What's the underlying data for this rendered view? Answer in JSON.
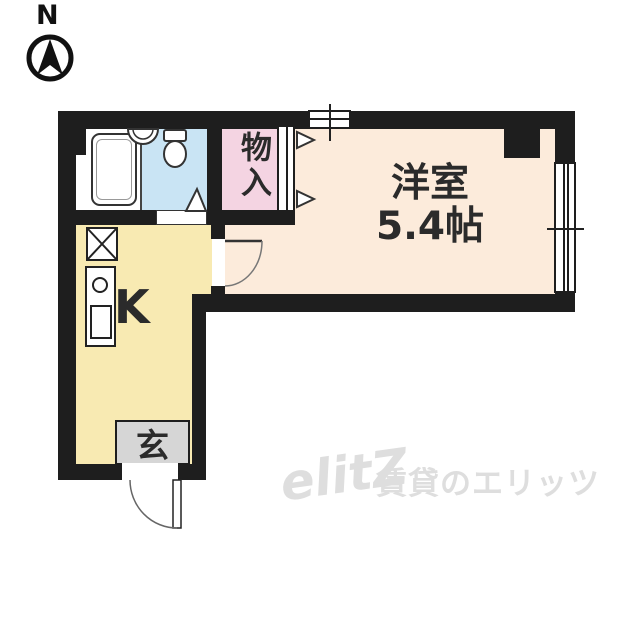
{
  "compass": {
    "label": "N"
  },
  "floor_plan": {
    "western_room": {
      "name": "洋室",
      "size": "5.4帖"
    },
    "kitchen": {
      "label": "K"
    },
    "entrance": {
      "label": "玄"
    },
    "closet": {
      "label": "物入"
    }
  },
  "watermark": {
    "logo": "elitZ",
    "text": "賃貸のエリッツ"
  },
  "colors": {
    "wall": "#1e1e1e",
    "western_room_floor": "#fcebdb",
    "kitchen_floor": "#f8eab2",
    "closet_floor": "#f4d4e2",
    "bathroom_floor": "#c9e4f4",
    "entrance_floor": "#d6d6d6",
    "watermark": "#dedede"
  }
}
